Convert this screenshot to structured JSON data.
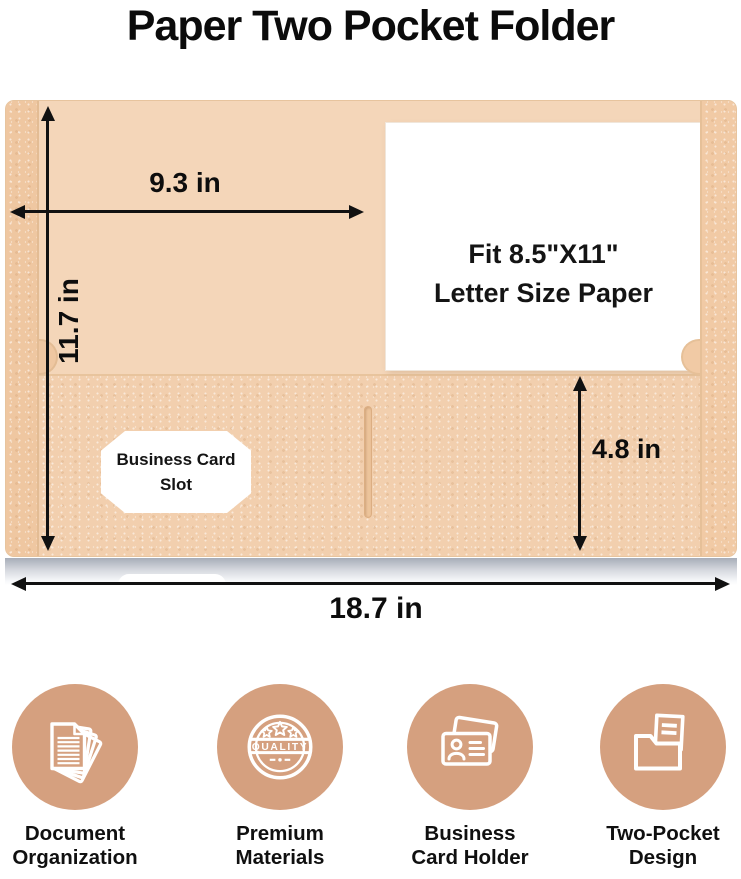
{
  "title": "Paper Two Pocket Folder",
  "diagram": {
    "width_label": "9.3 in",
    "height_label": "11.7 in",
    "pocket_height_label": "4.8 in",
    "total_width_label": "18.7 in",
    "paper_line1": "Fit 8.5\"X11\"",
    "paper_line2": "Letter Size Paper",
    "card_slot_line1": "Business Card",
    "card_slot_line2": "Slot"
  },
  "features": [
    {
      "icon": "document-stack-icon",
      "line1": "Document",
      "line2": "Organization"
    },
    {
      "icon": "quality-badge-icon",
      "line1": "Premium",
      "line2": "Materials",
      "badge_text": "QUALITY"
    },
    {
      "icon": "business-card-icon",
      "line1": "Business",
      "line2": "Card Holder"
    },
    {
      "icon": "two-pocket-folder-icon",
      "line1": "Two-Pocket",
      "line2": "Design"
    }
  ],
  "colors": {
    "folder_base": "#f4d6b9",
    "folder_spine": "#efc7a1",
    "folder_pocket": "#f2cfae",
    "paper_white": "#ffffff",
    "feature_circle": "#d5a07f",
    "text_dark": "#0f0f0f",
    "shadow_gray": "#a7adb8"
  }
}
